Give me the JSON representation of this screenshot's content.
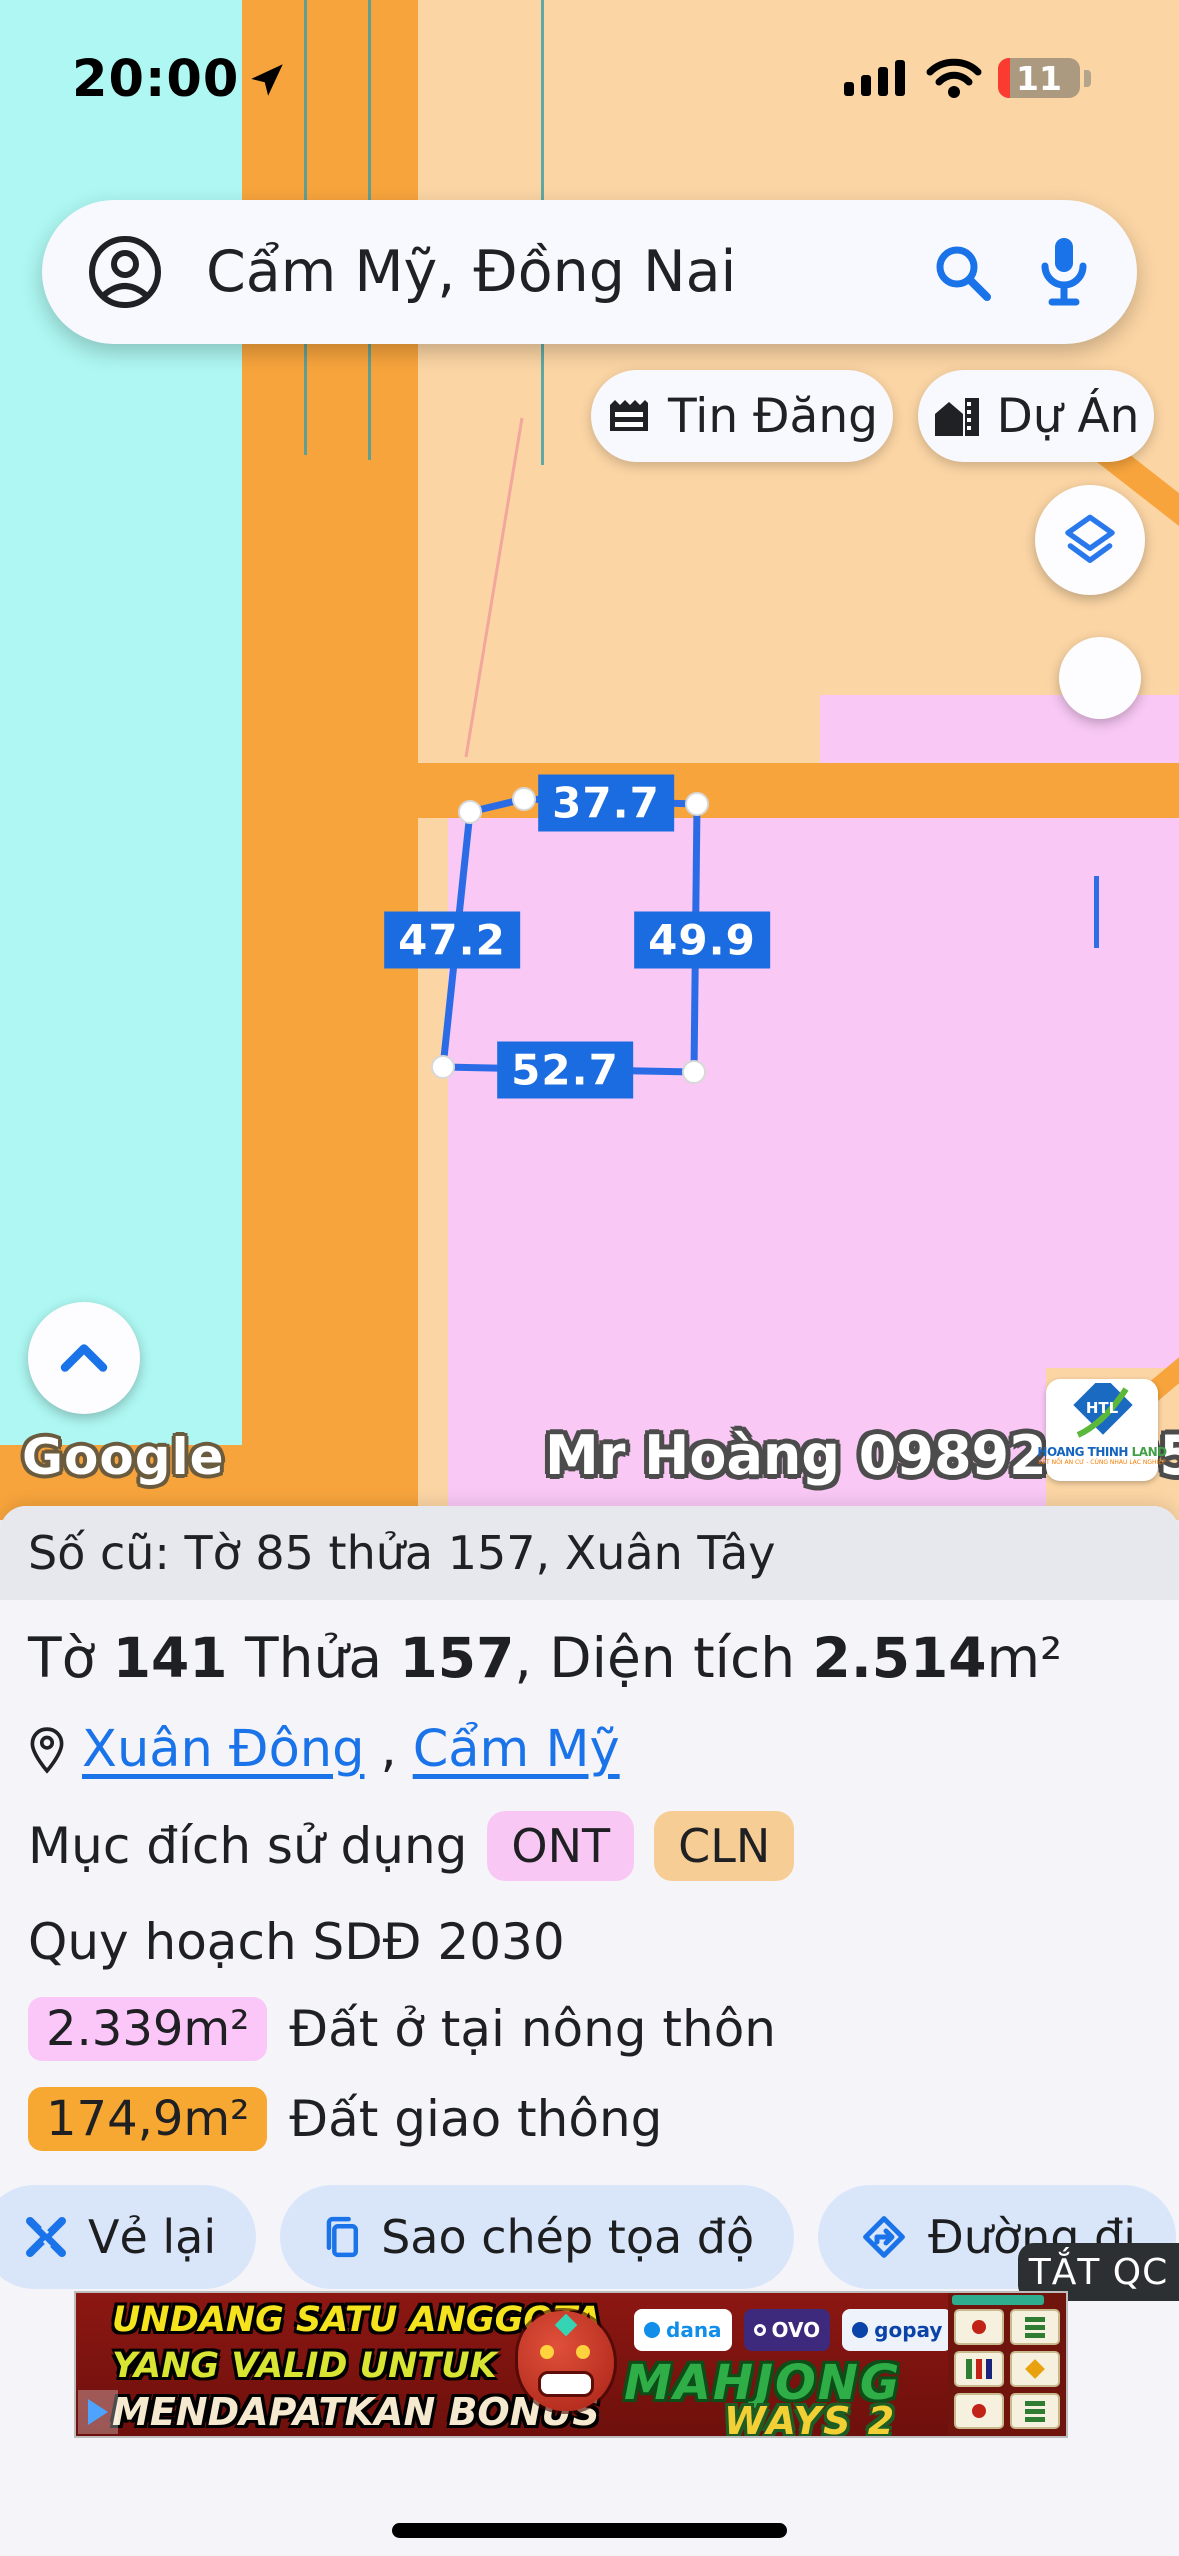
{
  "status_bar": {
    "time": "20:00",
    "battery_level": "11"
  },
  "search": {
    "query": "Cẩm Mỹ, Đồng Nai"
  },
  "map_buttons": {
    "tin_dang": "Tin Đăng",
    "du_an": "Dự Án"
  },
  "map": {
    "measurements": {
      "top": "37.7",
      "left": "47.2",
      "right": "49.9",
      "bottom": "52.7"
    },
    "watermark": "Mr Hoàng 0989268955",
    "google_logo": "Google",
    "vendor_logo": {
      "monogram": "HTL",
      "name_main": "HOANG THINH ",
      "name_accent": "LAND",
      "tagline": "KẾT NỐI AN CƯ - CÙNG NHAU LẠC NGHIỆP"
    }
  },
  "parcel_panel": {
    "old_number": "Số cũ: Tờ 85 thửa 157, Xuân Tây",
    "sheet_label": "Tờ ",
    "sheet_value": "141",
    "plot_label": " Thửa ",
    "plot_value": "157",
    "area_label": ", Diện tích ",
    "area_value": "2.514",
    "area_unit": "m²",
    "location": {
      "ward": "Xuân Đông",
      "separator": ", ",
      "district": "Cẩm Mỹ"
    },
    "land_use_label": "Mục đích sử dụng",
    "land_use_badges": [
      {
        "code": "ONT"
      },
      {
        "code": "CLN"
      }
    ],
    "planning_title": "Quy hoạch SDĐ 2030",
    "planning_items": [
      {
        "area": "2.339m²",
        "label": "Đất ở tại nông thôn"
      },
      {
        "area": "174,9m²",
        "label": "Đất giao thông"
      }
    ]
  },
  "toolbar": {
    "redraw": "Vẻ lại",
    "copy": "Sao chép tọa độ",
    "directions": "Đường đi"
  },
  "ad": {
    "dismiss": "TẮT QC",
    "line1": "UNDANG SATU ANGGOTA",
    "line2": "YANG VALID UNTUK",
    "line3": "MENDAPATKAN BONUS",
    "brand1": "MAHJONG",
    "brand2": "WAYS 2",
    "payments": [
      "dana",
      "OVO",
      "gopay"
    ]
  },
  "colors": {
    "accent_blue": "#1a73e8",
    "measure_label": "#1b6ce0",
    "map_water": "#aef7f2",
    "map_road": "#f7a43c",
    "map_land": "#fbd5a4",
    "map_parcel": "#f9c8f5",
    "badge_ont": "#f8c7f3",
    "badge_cln": "#f6cd94",
    "badge_orange": "#f6a832"
  }
}
